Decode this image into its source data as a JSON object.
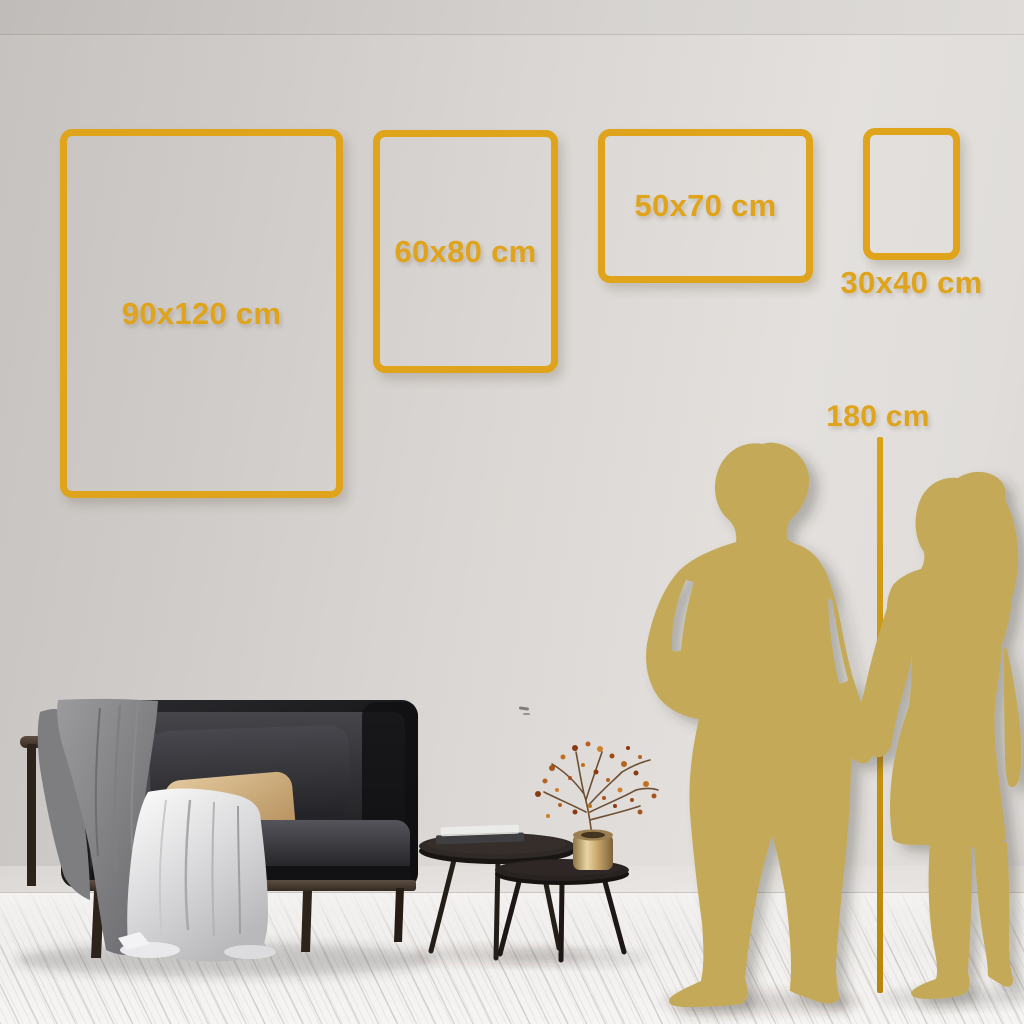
{
  "title": "Poster size comparison in interior",
  "colors": {
    "accent_gold": "#dfa41c",
    "height_line_gold": "#c9940f",
    "silhouette_gold": "#c3a959",
    "wall_gray": "#d9d5d2",
    "floor_white": "#f3f1ef",
    "sofa_charcoal": "#141416",
    "pillow_beige": "#d3ae7c"
  },
  "frames": [
    {
      "id": "90x120",
      "label": "90x120 cm",
      "orientation": "portrait",
      "label_position": "inside"
    },
    {
      "id": "60x80",
      "label": "60x80 cm",
      "orientation": "portrait",
      "label_position": "inside"
    },
    {
      "id": "50x70",
      "label": "50x70 cm",
      "orientation": "landscape",
      "label_position": "inside"
    },
    {
      "id": "30x40",
      "label": "30x40 cm",
      "orientation": "portrait",
      "label_position": "below"
    }
  ],
  "height_reference": {
    "label": "180 cm"
  },
  "scene_objects": [
    "dark-sofa",
    "gray-throw-blanket",
    "white-drape-cloth",
    "beige-pillow",
    "gray-cushions",
    "nesting-coffee-tables",
    "stacked-books",
    "brass-vase",
    "dried-berry-branch",
    "man-silhouette",
    "woman-silhouette"
  ]
}
